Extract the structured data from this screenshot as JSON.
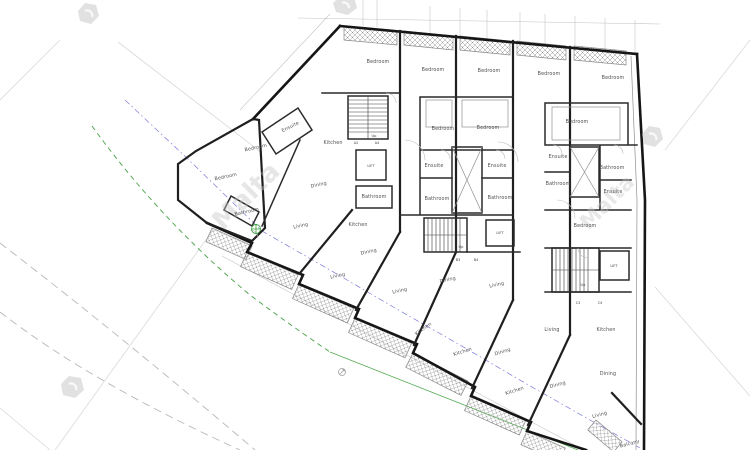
{
  "watermark": {
    "text": "Malta"
  },
  "labels": {
    "lift": "LIFT",
    "up": "Up"
  },
  "colors": {
    "wall": "#1f1f1f",
    "boundary_green": "#46a046",
    "setback_blue": "#6b6bd6",
    "dashed_grey": "#b7b7b7",
    "watermark_grey": "#c6c6c6",
    "label_grey": "#4f4f4f",
    "background": "#ffffff"
  },
  "rooms": [
    {
      "label": "Bedroom",
      "x": 378,
      "y": 63,
      "r": 0
    },
    {
      "label": "Bedroom",
      "x": 433,
      "y": 71,
      "r": 0
    },
    {
      "label": "Bedroom",
      "x": 489,
      "y": 72,
      "r": 0
    },
    {
      "label": "Bedroom",
      "x": 549,
      "y": 75,
      "r": 0
    },
    {
      "label": "Bedroom",
      "x": 613,
      "y": 79,
      "r": 0
    },
    {
      "label": "Ensuite",
      "x": 291,
      "y": 128,
      "r": -27
    },
    {
      "label": "Bedroom",
      "x": 256,
      "y": 149,
      "r": -12
    },
    {
      "label": "Bedroom",
      "x": 226,
      "y": 178,
      "r": -12
    },
    {
      "label": "Bathroom",
      "x": 247,
      "y": 213,
      "r": -12
    },
    {
      "label": "Kitchen",
      "x": 333,
      "y": 144,
      "r": 0
    },
    {
      "label": "Dining",
      "x": 319,
      "y": 186,
      "r": -12
    },
    {
      "label": "Living",
      "x": 301,
      "y": 227,
      "r": -12
    },
    {
      "label": "Bathroom",
      "x": 374,
      "y": 198,
      "r": 0
    },
    {
      "label": "Kitchen",
      "x": 358,
      "y": 226,
      "r": 0
    },
    {
      "label": "Dining",
      "x": 369,
      "y": 253,
      "r": -12
    },
    {
      "label": "Living",
      "x": 338,
      "y": 277,
      "r": -12
    },
    {
      "label": "Bedroom",
      "x": 443,
      "y": 130,
      "r": 0
    },
    {
      "label": "Bedroom",
      "x": 488,
      "y": 129,
      "r": 0
    },
    {
      "label": "Ensuite",
      "x": 434,
      "y": 167,
      "r": 0
    },
    {
      "label": "Ensuite",
      "x": 497,
      "y": 167,
      "r": 0
    },
    {
      "label": "Bathroom",
      "x": 437,
      "y": 200,
      "r": 0
    },
    {
      "label": "Bathroom",
      "x": 500,
      "y": 199,
      "r": 0
    },
    {
      "label": "Living",
      "x": 400,
      "y": 292,
      "r": -12
    },
    {
      "label": "Dining",
      "x": 448,
      "y": 281,
      "r": -12
    },
    {
      "label": "Living",
      "x": 497,
      "y": 286,
      "r": -12
    },
    {
      "label": "Kitchen",
      "x": 424,
      "y": 330,
      "r": -35
    },
    {
      "label": "Kitchen",
      "x": 463,
      "y": 353,
      "r": -18
    },
    {
      "label": "Dining",
      "x": 503,
      "y": 353,
      "r": -18
    },
    {
      "label": "Kitchen",
      "x": 515,
      "y": 392,
      "r": -18
    },
    {
      "label": "Bedroom",
      "x": 577,
      "y": 123,
      "r": 0
    },
    {
      "label": "Ensuite",
      "x": 558,
      "y": 158,
      "r": 0
    },
    {
      "label": "Bathroom",
      "x": 558,
      "y": 185,
      "r": 0
    },
    {
      "label": "Bathroom",
      "x": 612,
      "y": 169,
      "r": 0
    },
    {
      "label": "Ensuite",
      "x": 613,
      "y": 193,
      "r": 0
    },
    {
      "label": "Bedroom",
      "x": 585,
      "y": 227,
      "r": 0
    },
    {
      "label": "Living",
      "x": 552,
      "y": 331,
      "r": 0
    },
    {
      "label": "Kitchen",
      "x": 606,
      "y": 331,
      "r": 0
    },
    {
      "label": "Dining",
      "x": 558,
      "y": 386,
      "r": -15
    },
    {
      "label": "Dining",
      "x": 608,
      "y": 375,
      "r": 0
    },
    {
      "label": "Living",
      "x": 600,
      "y": 416,
      "r": -15
    },
    {
      "label": "Balcony",
      "x": 630,
      "y": 445,
      "r": -15
    }
  ],
  "section_markers": [
    {
      "label": "A2",
      "x": 356,
      "y": 144
    },
    {
      "label": "A4",
      "x": 377,
      "y": 144
    },
    {
      "label": "B3",
      "x": 458,
      "y": 261
    },
    {
      "label": "B4",
      "x": 476,
      "y": 261
    },
    {
      "label": "C3",
      "x": 578,
      "y": 304
    },
    {
      "label": "C4",
      "x": 600,
      "y": 304
    }
  ]
}
